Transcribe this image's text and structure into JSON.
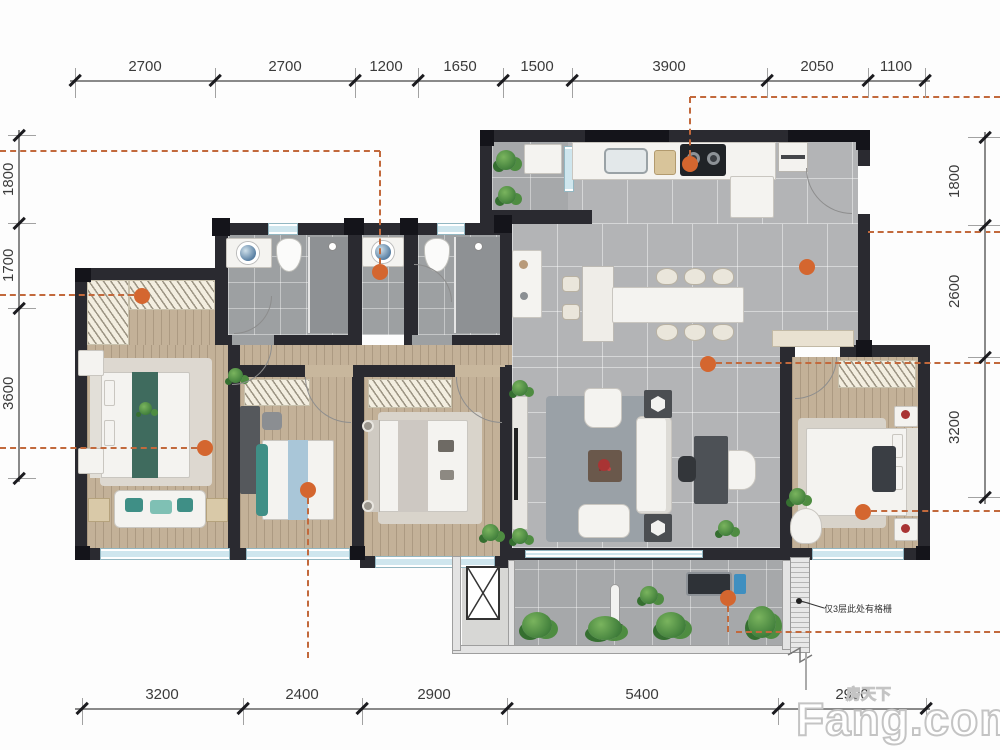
{
  "plan": {
    "annotation": "仅3层此处有格栅",
    "watermark": {
      "brand": "Fang.com",
      "cn": "房天下"
    },
    "dimensions": {
      "top": [
        "2700",
        "2700",
        "1200",
        "1650",
        "1500",
        "3900",
        "2050",
        "1100"
      ],
      "bottom": [
        "3200",
        "2400",
        "2900",
        "5400",
        "2900"
      ],
      "left": [
        "1800",
        "1700",
        "3600"
      ],
      "right": [
        "1800",
        "2600",
        "3200"
      ]
    },
    "colors": {
      "wall": "#2a2a30",
      "dashed": "#c2693c",
      "marker_dot": "#d4662f",
      "wood": "#c3b198",
      "tile": "#b3b4b6",
      "window": "#cfe6ee",
      "plant": "#3f7d3a",
      "accent_teal": "#3f8f86"
    }
  }
}
